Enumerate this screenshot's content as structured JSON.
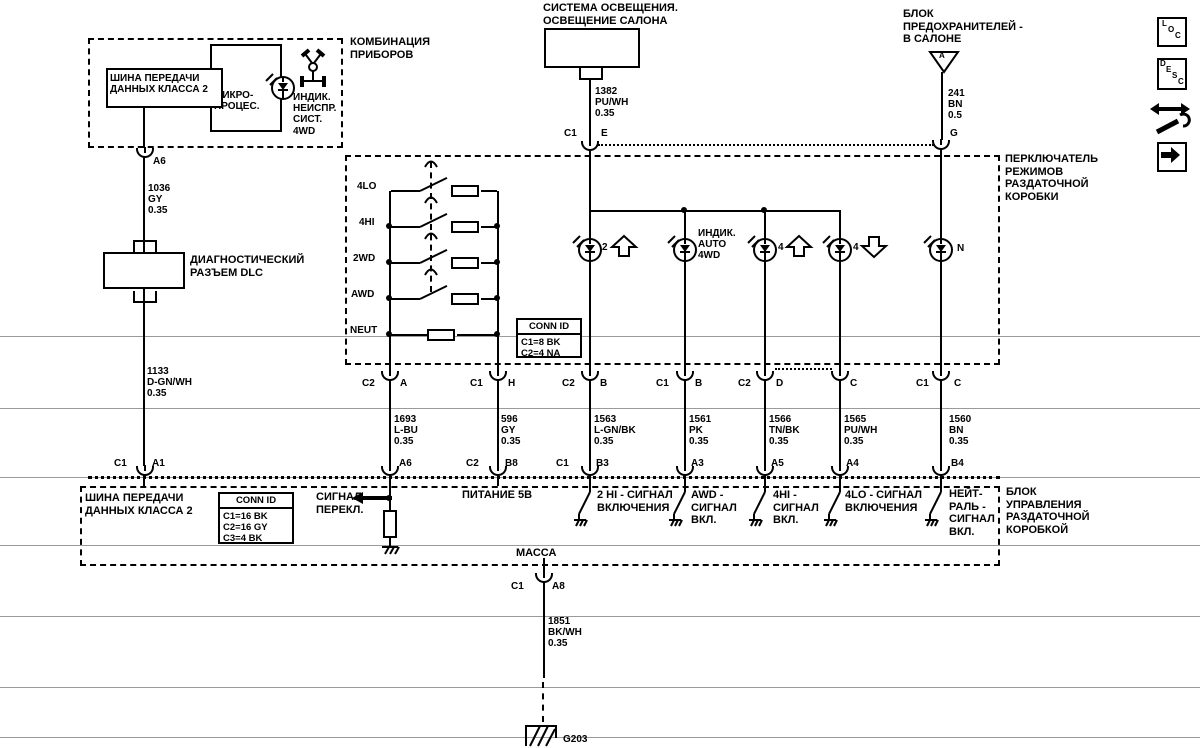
{
  "colors": {
    "line": "#000000",
    "grid": "#999999",
    "bg": "#ffffff"
  },
  "cluster": {
    "label": "КОМБИНАЦИЯ\nПРИБОРОВ",
    "bus": "ШИНА ПЕРЕДАЧИ\nДАННЫХ КЛАССА 2",
    "micro": "МИКРО-\nПРОЦЕС.",
    "indicator": "ИНДИК.\nНЕИСПР.\nСИСТ.\n4WD"
  },
  "lighting": {
    "title": "СИСТЕМА ОСВЕЩЕНИЯ.\nОСВЕЩЕНИЕ САЛОНА"
  },
  "fuse": {
    "title": "БЛОК\nПРЕДОХРАНИТЕЛЕЙ -\nВ САЛОНЕ",
    "tri": "A"
  },
  "dlc": {
    "label": "ДИАГНОСТИЧЕСКИЙ\nРАЗЪЕМ DLC"
  },
  "tsw": {
    "label": "ПЕРКЛЮЧАТЕЛЬ\nРЕЖИМОВ\nРАЗДАТОЧНОЙ\nКОРОБКИ",
    "pos": [
      "4LO",
      "4HI",
      "2WD",
      "AWD",
      "NEUT"
    ],
    "conn": {
      "title": "CONN ID",
      "rows": "C1=8 BK\nC2=4 NA"
    },
    "lamp2": "2",
    "auto": "ИНДИК.\nAUTO\n4WD",
    "l4hi": "4",
    "l4lo": "4",
    "lN": "N"
  },
  "tccm": {
    "label": "БЛОК\nУПРАВЛЕНИЯ\nРАЗДАТОЧНОЙ\nКОРОБКОЙ",
    "conn": {
      "title": "CONN ID",
      "rows": "C1=16 BK\nC2=16 GY\nC3=4 BK"
    },
    "bus": "ШИНА ПЕРЕДАЧИ\nДАННЫХ КЛАССА 2",
    "sig": "СИГНАЛ\nПЕРЕКЛ.",
    "p5": "ПИТАНИЕ 5В",
    "hi2": "2 HI - СИГНАЛ\nВКЛЮЧЕНИЯ",
    "awd": "AWD -\nСИГНАЛ\nВКЛ.",
    "hi4": "4HI -\nСИГНАЛ\nВКЛ.",
    "lo4": "4LO - СИГНАЛ\nВКЛЮЧЕНИЯ",
    "neut": "НЕЙТ-\nРАЛЬ -\nСИГНАЛ\nВКЛ.",
    "mass": "МАССА"
  },
  "wires": {
    "w1036": "1036\nGY\n0.35",
    "w1133": "1133\nD-GN/WH\n0.35",
    "w1382": "1382\nPU/WH\n0.35",
    "w241": "241\nBN\n0.5",
    "w1693": "1693\nL-BU\n0.35",
    "w596": "596\nGY\n0.35",
    "w1563": "1563\nL-GN/BK\n0.35",
    "w1561": "1561\nPK\n0.35",
    "w1566": "1566\nTN/BK\n0.35",
    "w1565": "1565\nPU/WH\n0.35",
    "w1560": "1560\nBN\n0.35",
    "w1851": "1851\nBK/WH\n0.35"
  },
  "pins": {
    "a6t": "A6",
    "e_c": "C1",
    "e_p": "E",
    "g_p": "G",
    "sw_a_c": "C2",
    "sw_a_p": "A",
    "sw_h_c": "C1",
    "sw_h_p": "H",
    "sw_b1_c": "C2",
    "sw_b1_p": "B",
    "sw_b2_c": "C1",
    "sw_b2_p": "B",
    "sw_d_c": "C2",
    "sw_d_p": "D",
    "sw_c1_p": "C",
    "sw_c2_c": "C1",
    "sw_c2_p": "C",
    "a1_c": "C1",
    "a1_p": "A1",
    "a6b": "A6",
    "b8_c": "C2",
    "b8_p": "B8",
    "b3_c": "C1",
    "b3_p": "B3",
    "a3": "A3",
    "a5": "A5",
    "a4": "A4",
    "b4": "B4",
    "a8_c": "C1",
    "a8_p": "A8"
  },
  "ground": {
    "g203": "G203"
  },
  "icons": {
    "loc": [
      "L",
      "O",
      "C"
    ],
    "desc": [
      "D",
      "E",
      "S",
      "C"
    ]
  }
}
